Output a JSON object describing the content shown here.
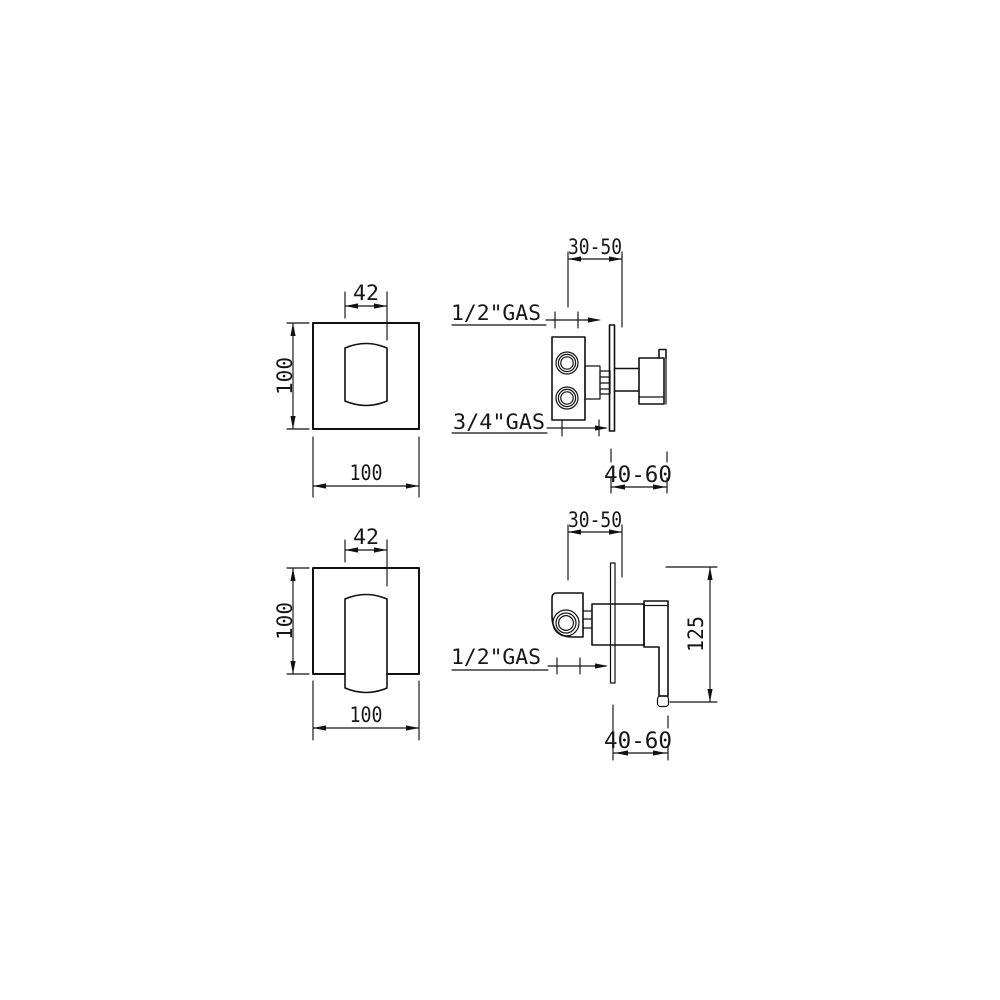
{
  "page": {
    "background": "#ffffff",
    "line_color": "#111111",
    "text_color": "#161616"
  },
  "views": {
    "top_front": {
      "handle_width": "42",
      "plate_height": "100",
      "plate_width": "100"
    },
    "top_side": {
      "wall_depth_range": "30-50",
      "top_inlet_label": "1/2\"GAS",
      "bottom_inlet_label": "3/4\"GAS",
      "recess_depth_range": "40-60"
    },
    "bottom_front": {
      "handle_width": "42",
      "plate_height": "100",
      "plate_width": "100"
    },
    "bottom_side": {
      "wall_depth_range": "30-50",
      "inlet_label": "1/2\"GAS",
      "handle_length": "125",
      "recess_depth_range": "40-60"
    }
  }
}
